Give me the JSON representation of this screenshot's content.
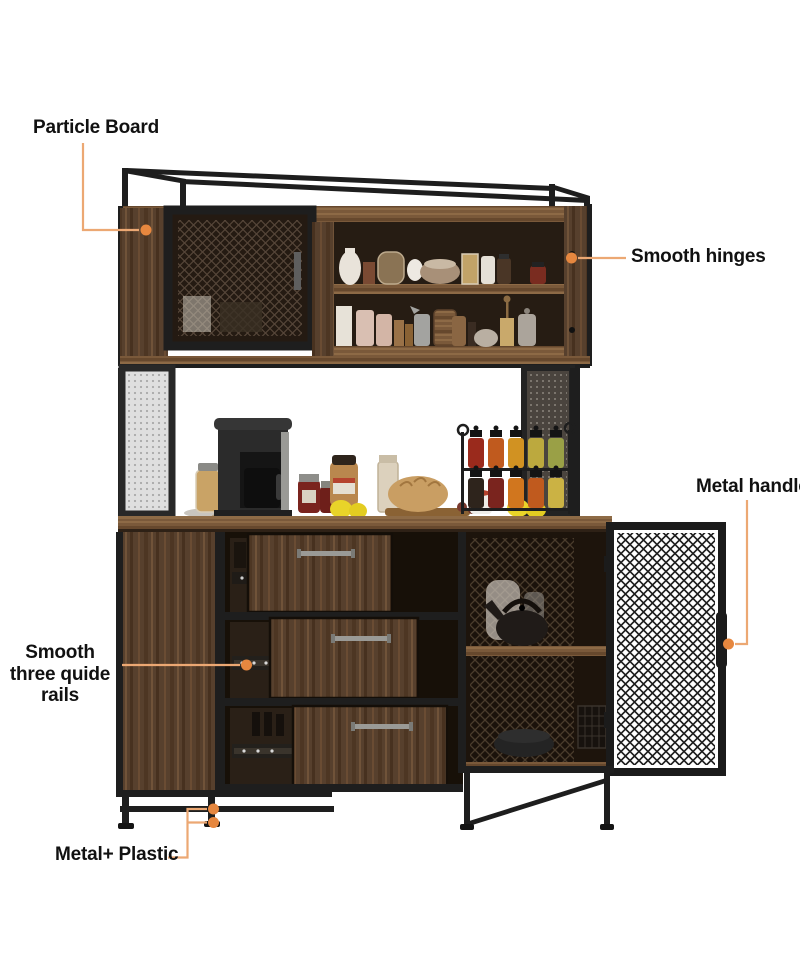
{
  "figure": {
    "alt": "Industrial kitchen buffet hutch cabinet with mesh doors, open shelves, three drawers and metal legs, annotated with feature callouts"
  },
  "colors": {
    "background": "#ffffff",
    "callout_line": "#ECA873",
    "callout_dot": "#E6873F",
    "label_text": "#111111",
    "metal_black": "#1E1E1E",
    "wood_brown": "#57402D",
    "counter_brown": "#7A593A"
  },
  "callouts": {
    "particle_board": {
      "label": "Particle Board"
    },
    "smooth_hinges": {
      "label": "Smooth hinges"
    },
    "metal_handle": {
      "label": "Metal handle"
    },
    "guide_rails": {
      "label": "Smooth three quide rails"
    },
    "metal_plastic": {
      "label": "Metal+ Plastic"
    }
  }
}
